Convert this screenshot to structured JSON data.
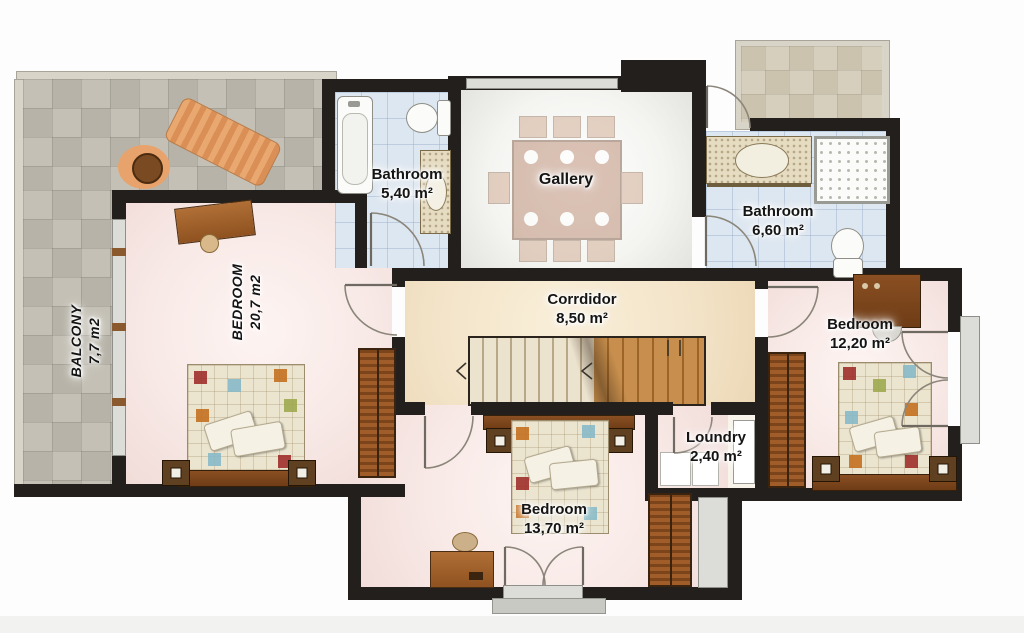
{
  "plan": {
    "rooms": {
      "balcony": {
        "name": "BALCONY",
        "area": "7,7 m2"
      },
      "bedroom_left": {
        "name": "BEDROOM",
        "area": "20,7 m2"
      },
      "bathroom_small": {
        "name": "Bathroom",
        "area": "5,40 m²"
      },
      "gallery": {
        "name": "Gallery"
      },
      "bathroom_right": {
        "name": "Bathroom",
        "area": "6,60 m²"
      },
      "corridor": {
        "name": "Corrdidor",
        "area": "8,50 m²"
      },
      "bedroom_right": {
        "name": "Bedroom",
        "area": "12,20 m²"
      },
      "laundry": {
        "name": "Loundry",
        "area": "2,40 m²"
      },
      "bedroom_bottom": {
        "name": "Bedroom",
        "area": "13,70 m²"
      }
    },
    "colors": {
      "wall": "#221f1c",
      "bedroom_floor": "#f8e9e6",
      "corridor_floor": "#f3e4c9",
      "bathroom_tile": "#dde7f1",
      "terrace_tile": "#b7b3a8",
      "wood": "#a9672f"
    }
  }
}
